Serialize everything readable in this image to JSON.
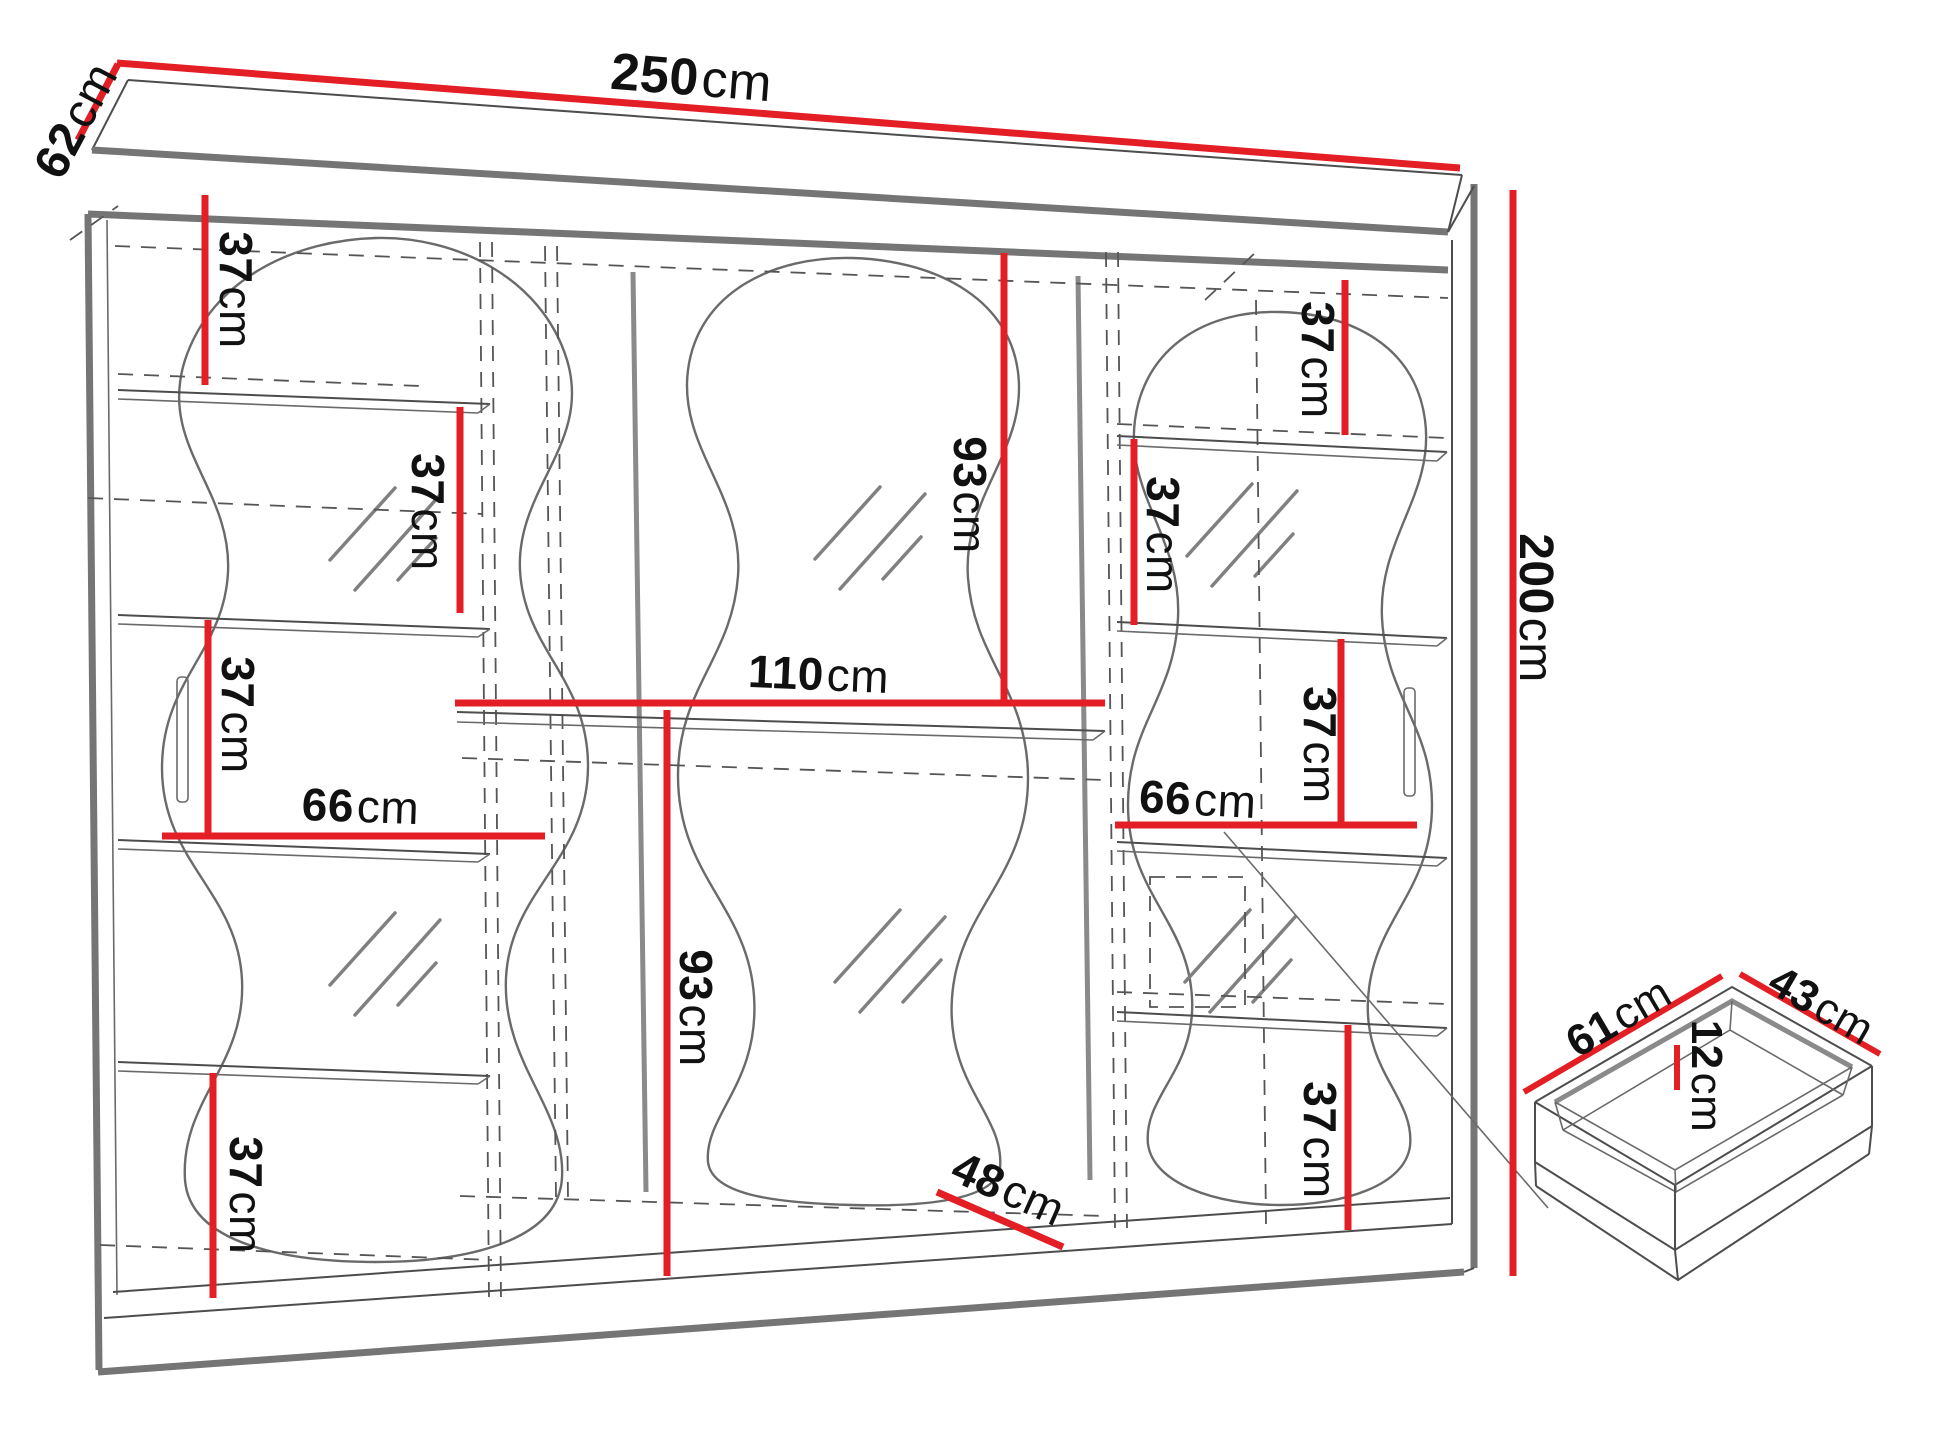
{
  "page": {
    "title": "Wardrobe technical dimension drawing",
    "background": "#ffffff"
  },
  "style": {
    "dimension_color": "#e31e24",
    "structure_color": "#4d4d4d",
    "panel_edge_color": "#757575"
  },
  "drawing": {
    "subject": "three-door mirrored sliding wardrobe",
    "detail": "pull-out drawer (isometric view, bottom right)"
  },
  "labels": {
    "width_250": {
      "value": "250",
      "unit": "cm"
    },
    "depth_62": {
      "value": "62",
      "unit": "cm"
    },
    "height_200": {
      "value": "200",
      "unit": "cm"
    },
    "shelf_37_left_top": {
      "value": "37",
      "unit": "cm"
    },
    "shelf_37_left_upper": {
      "value": "37",
      "unit": "cm"
    },
    "shelf_37_left_middle": {
      "value": "37",
      "unit": "cm"
    },
    "shelf_37_left_bottom": {
      "value": "37",
      "unit": "cm"
    },
    "width_66_left": {
      "value": "66",
      "unit": "cm"
    },
    "height_93_upper": {
      "value": "93",
      "unit": "cm"
    },
    "width_110_middle": {
      "value": "110",
      "unit": "cm"
    },
    "height_93_lower": {
      "value": "93",
      "unit": "cm"
    },
    "width_48_bottom": {
      "value": "48",
      "unit": "cm"
    },
    "shelf_37_right_top": {
      "value": "37",
      "unit": "cm"
    },
    "shelf_37_right_upper": {
      "value": "37",
      "unit": "cm"
    },
    "shelf_37_right_middle": {
      "value": "37",
      "unit": "cm"
    },
    "shelf_37_right_bottom": {
      "value": "37",
      "unit": "cm"
    },
    "width_66_right": {
      "value": "66",
      "unit": "cm"
    },
    "drawer_width_61": {
      "value": "61",
      "unit": "cm"
    },
    "drawer_depth_43": {
      "value": "43",
      "unit": "cm"
    },
    "drawer_height_12": {
      "value": "12",
      "unit": "cm"
    }
  }
}
